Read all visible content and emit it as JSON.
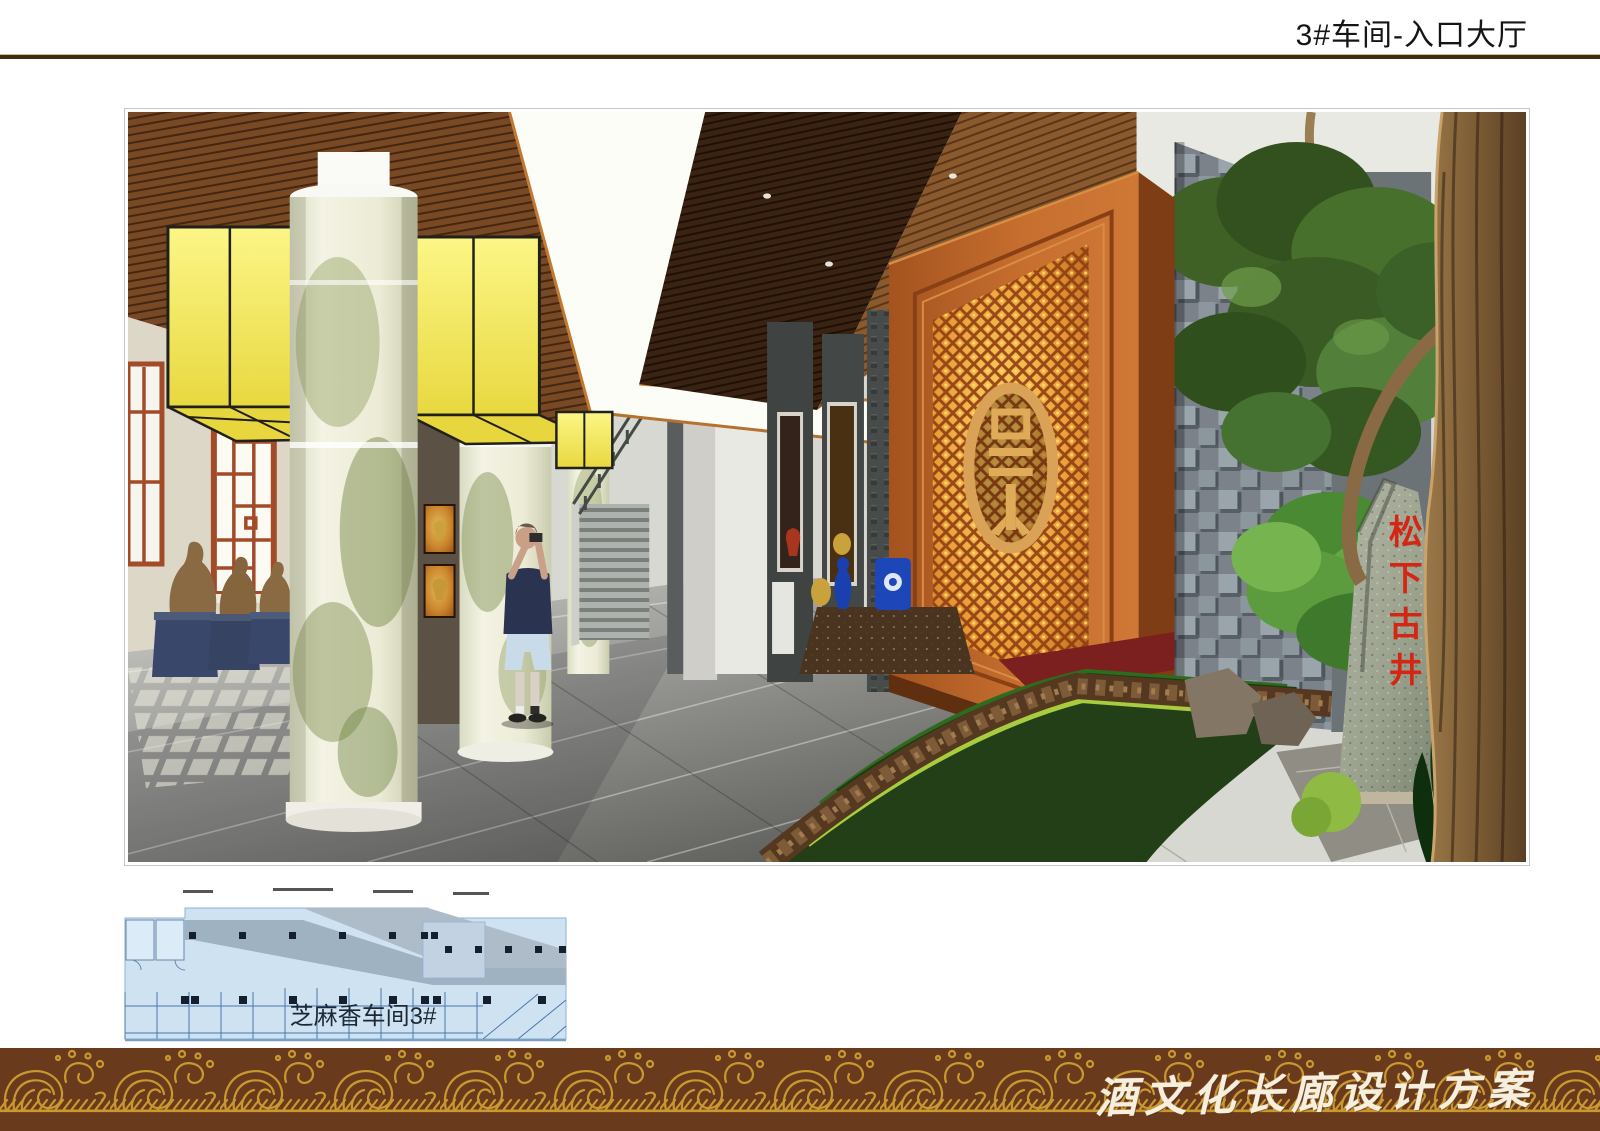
{
  "header": {
    "title": "3#车间-入口大厅"
  },
  "footer": {
    "brand_text": "酒文化长廊设计方案"
  },
  "floor_plan": {
    "label": "芝麻香车间3#"
  },
  "scene": {
    "description": "入口大厅效果图",
    "stone_inscription": "松下古井",
    "emblem_character": "景"
  },
  "colors": {
    "rule_brown": "#3f2c12",
    "band_brown": "#6a3a1d",
    "band_gold": "#c9992f",
    "footer_text": "#f7efdd",
    "plan_fill": "#cfe2f2",
    "plan_corridor": "#9fb2c2",
    "plan_line": "#4a78a8",
    "plan_text": "#1c2836",
    "stone_text_red": "#d42614",
    "orange_wall": "#bb6228",
    "lightbox_yellow": "#f2e95e",
    "ceiling_wood": "#7a4a22"
  }
}
